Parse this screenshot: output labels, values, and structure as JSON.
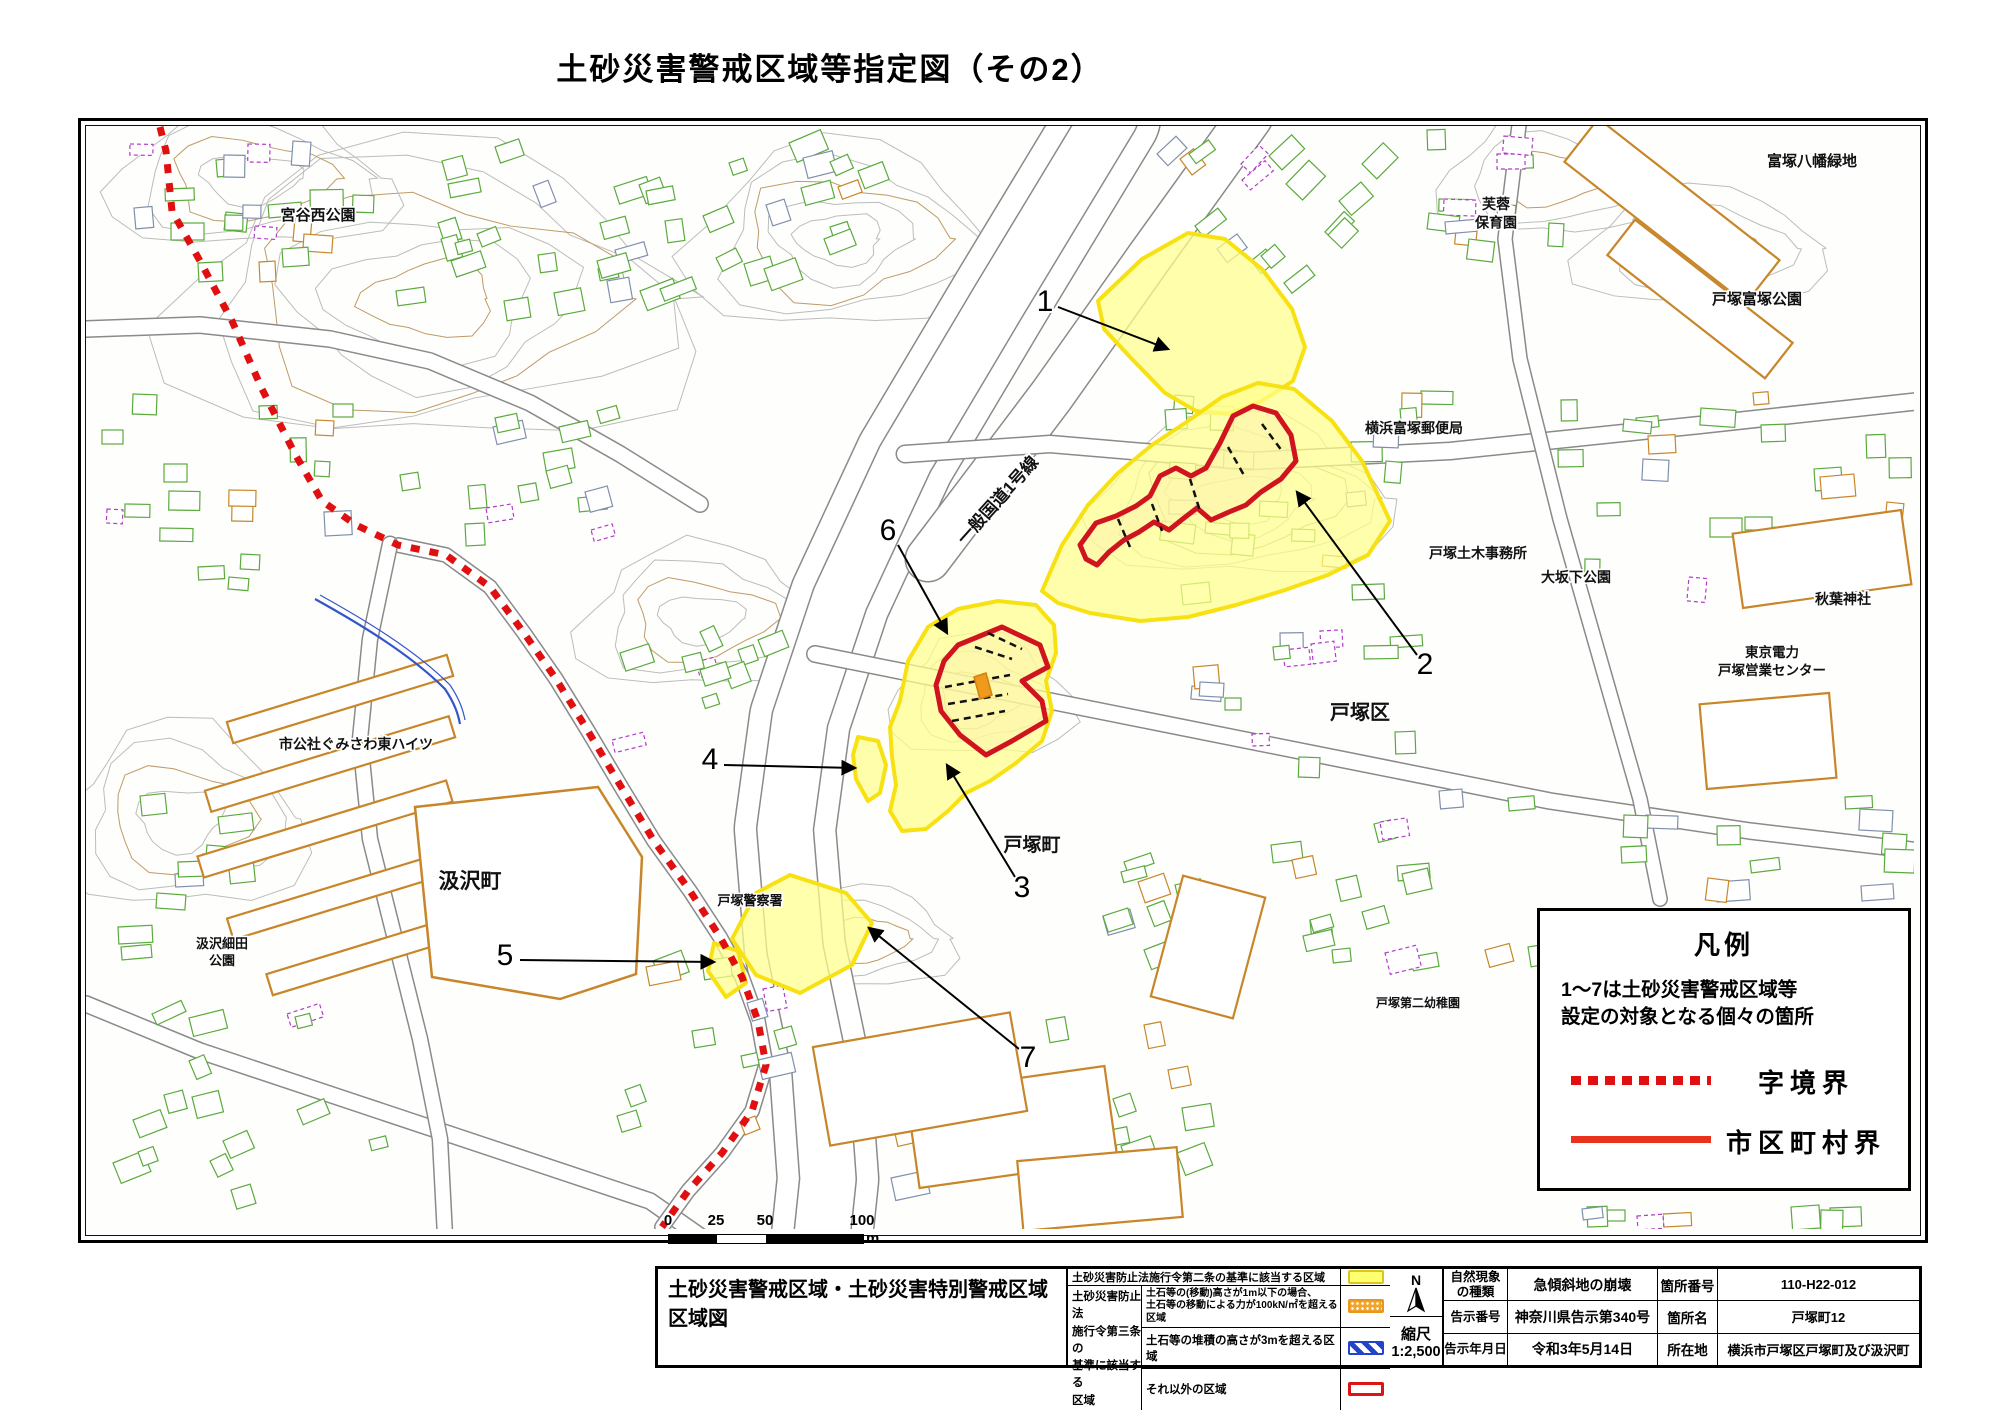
{
  "title": "土砂災害警戒区域等指定図（その2）",
  "colors": {
    "warning_yellow_fill": "#ffff8c",
    "warning_yellow_border": "#f7e112",
    "special_red": "#cf1420",
    "orange_zone": "#ef9a1c",
    "boundary_dotted_red": "#e01010",
    "municipal_solid_red": "#e8321e",
    "blue_zone": "#2244cc"
  },
  "legend_box": {
    "title": "凡例",
    "note_line1": "1～7は土砂災害警戒区域等",
    "note_line2": "設定の対象となる個々の箇所",
    "items": [
      {
        "style": "dotted",
        "label": "字境界"
      },
      {
        "style": "solid",
        "label": "市区町村界"
      }
    ]
  },
  "scale_bar": {
    "t0": "0",
    "t25": "25",
    "t50": "50",
    "t100": "100",
    "unit": "m"
  },
  "info_table": {
    "block_title_1": "土砂災害警戒区域・土砂災害特別警戒区域",
    "block_title_2": "区域図",
    "law2_text": "土砂災害防止法施行令第二条の基準に該当する区域",
    "law3_l1": "土砂災害防止法",
    "law3_l2": "施行令第三条の",
    "law3_l3": "基準に該当する",
    "law3_l4": "区域",
    "law3_row1a": "土石等の(移動)高さが1m以下の場合、",
    "law3_row1b": "土石等の移動による力が100kN/㎡を超える区域",
    "law3_row2": "土石等の堆積の高さが3mを超える区域",
    "law3_row3": "それ以外の区域",
    "compass_n": "N",
    "scale_label": "縮尺",
    "scale_value": "1:2,500",
    "nat_label_1": "自然現象",
    "nat_label_2": "の種類",
    "nat_value": "急傾斜地の崩壊",
    "site_no_label": "箇所番号",
    "site_no_value": "110-H22-012",
    "notice_label": "告示番号",
    "notice_value": "神奈川県告示第340号",
    "site_name_label": "箇所名",
    "site_name_value": "戸塚町12",
    "date_label": "告示年月日",
    "date_value": "令和3年5月14日",
    "loc_label": "所在地",
    "loc_value": "横浜市戸塚区戸塚町及び汲沢町"
  },
  "map": {
    "road_label": {
      "text": "一般国道1号線",
      "x": 1002,
      "y": 505,
      "angle": -48,
      "size": 17
    },
    "labels": [
      {
        "t": [
          "宮谷西公園"
        ],
        "x": 318,
        "y": 221,
        "s": 15
      },
      {
        "t": [
          "富塚八幡緑地"
        ],
        "x": 1812,
        "y": 167,
        "s": 15
      },
      {
        "t": [
          "芙蓉",
          "保育園"
        ],
        "x": 1496,
        "y": 210,
        "s": 14
      },
      {
        "t": [
          "戸塚富塚公園"
        ],
        "x": 1757,
        "y": 305,
        "s": 15
      },
      {
        "t": [
          "横浜富塚郵便局"
        ],
        "x": 1414,
        "y": 434,
        "s": 14
      },
      {
        "t": [
          "戸塚土木事務所"
        ],
        "x": 1478,
        "y": 559,
        "s": 14
      },
      {
        "t": [
          "大坂下公園"
        ],
        "x": 1576,
        "y": 583,
        "s": 14
      },
      {
        "t": [
          "秋葉神社"
        ],
        "x": 1843,
        "y": 605,
        "s": 14
      },
      {
        "t": [
          "東京電力",
          "戸塚営業センター"
        ],
        "x": 1772,
        "y": 658,
        "s": 13.5
      },
      {
        "t": [
          "戸塚区"
        ],
        "x": 1360,
        "y": 720,
        "s": 20
      },
      {
        "t": [
          "市公社ぐみさわ東ハイツ"
        ],
        "x": 356,
        "y": 750,
        "s": 14
      },
      {
        "t": [
          "汲沢町"
        ],
        "x": 470,
        "y": 889,
        "s": 21
      },
      {
        "t": [
          "汲沢細田",
          "公園"
        ],
        "x": 222,
        "y": 949,
        "s": 13
      },
      {
        "t": [
          "戸塚警察署"
        ],
        "x": 750,
        "y": 906,
        "s": 13
      },
      {
        "t": [
          "戸塚町"
        ],
        "x": 1032,
        "y": 852,
        "s": 19
      },
      {
        "t": [
          "戸塚第二幼稚園"
        ],
        "x": 1418,
        "y": 1008,
        "s": 12
      }
    ],
    "sites": [
      {
        "n": "1",
        "tx": 1045,
        "ty": 304,
        "x1": 1058,
        "y1": 308,
        "x2": 1168,
        "y2": 350
      },
      {
        "n": "2",
        "tx": 1425,
        "ty": 667,
        "x1": 1417,
        "y1": 656,
        "x2": 1297,
        "y2": 493
      },
      {
        "n": "3",
        "tx": 1022,
        "ty": 890,
        "x1": 1015,
        "y1": 878,
        "x2": 947,
        "y2": 766
      },
      {
        "n": "4",
        "tx": 710,
        "ty": 762,
        "x1": 724,
        "y1": 766,
        "x2": 855,
        "y2": 769
      },
      {
        "n": "5",
        "tx": 505,
        "ty": 958,
        "x1": 520,
        "y1": 961,
        "x2": 714,
        "y2": 963
      },
      {
        "n": "6",
        "tx": 888,
        "ty": 533,
        "x1": 898,
        "y1": 546,
        "x2": 947,
        "y2": 634
      },
      {
        "n": "7",
        "tx": 1028,
        "ty": 1060,
        "x1": 1019,
        "y1": 1050,
        "x2": 869,
        "y2": 929
      }
    ],
    "zones_yellow": [
      [
        [
          1098,
          302
        ],
        [
          1142,
          260
        ],
        [
          1188,
          234
        ],
        [
          1225,
          240
        ],
        [
          1262,
          270
        ],
        [
          1292,
          310
        ],
        [
          1305,
          348
        ],
        [
          1293,
          382
        ],
        [
          1262,
          402
        ],
        [
          1228,
          415
        ],
        [
          1196,
          412
        ],
        [
          1165,
          394
        ],
        [
          1130,
          358
        ],
        [
          1104,
          330
        ]
      ],
      [
        [
          1042,
          592
        ],
        [
          1062,
          546
        ],
        [
          1088,
          506
        ],
        [
          1118,
          474
        ],
        [
          1152,
          446
        ],
        [
          1188,
          422
        ],
        [
          1222,
          398
        ],
        [
          1258,
          384
        ],
        [
          1294,
          390
        ],
        [
          1332,
          422
        ],
        [
          1362,
          462
        ],
        [
          1390,
          522
        ],
        [
          1368,
          556
        ],
        [
          1328,
          576
        ],
        [
          1282,
          592
        ],
        [
          1236,
          606
        ],
        [
          1188,
          618
        ],
        [
          1140,
          622
        ],
        [
          1090,
          614
        ],
        [
          1058,
          604
        ]
      ],
      [
        [
          900,
          702
        ],
        [
          908,
          662
        ],
        [
          928,
          628
        ],
        [
          958,
          610
        ],
        [
          998,
          602
        ],
        [
          1036,
          606
        ],
        [
          1054,
          626
        ],
        [
          1056,
          654
        ],
        [
          1046,
          682
        ],
        [
          1052,
          712
        ],
        [
          1042,
          742
        ],
        [
          1016,
          764
        ],
        [
          990,
          782
        ],
        [
          966,
          794
        ],
        [
          948,
          812
        ],
        [
          926,
          830
        ],
        [
          902,
          832
        ],
        [
          890,
          812
        ],
        [
          896,
          786
        ],
        [
          892,
          758
        ],
        [
          890,
          728
        ]
      ],
      [
        [
          858,
          738
        ],
        [
          878,
          742
        ],
        [
          886,
          766
        ],
        [
          880,
          794
        ],
        [
          868,
          802
        ],
        [
          856,
          780
        ],
        [
          853,
          756
        ]
      ],
      [
        [
          790,
          876
        ],
        [
          846,
          894
        ],
        [
          872,
          924
        ],
        [
          852,
          966
        ],
        [
          800,
          994
        ],
        [
          756,
          976
        ],
        [
          732,
          940
        ],
        [
          756,
          894
        ]
      ],
      [
        [
          714,
          944
        ],
        [
          738,
          952
        ],
        [
          746,
          984
        ],
        [
          726,
          998
        ],
        [
          708,
          972
        ]
      ]
    ],
    "zones_red": [
      [
        [
          1080,
          546
        ],
        [
          1096,
          524
        ],
        [
          1116,
          517
        ],
        [
          1136,
          507
        ],
        [
          1150,
          497
        ],
        [
          1160,
          477
        ],
        [
          1176,
          469
        ],
        [
          1191,
          477
        ],
        [
          1206,
          469
        ],
        [
          1220,
          444
        ],
        [
          1233,
          417
        ],
        [
          1253,
          407
        ],
        [
          1276,
          414
        ],
        [
          1291,
          436
        ],
        [
          1296,
          462
        ],
        [
          1281,
          480
        ],
        [
          1261,
          493
        ],
        [
          1246,
          506
        ],
        [
          1229,
          513
        ],
        [
          1211,
          521
        ],
        [
          1197,
          509
        ],
        [
          1184,
          519
        ],
        [
          1169,
          531
        ],
        [
          1154,
          523
        ],
        [
          1139,
          533
        ],
        [
          1124,
          541
        ],
        [
          1109,
          553
        ],
        [
          1097,
          566
        ],
        [
          1086,
          560
        ]
      ],
      [
        [
          958,
          646
        ],
        [
          1002,
          628
        ],
        [
          1040,
          646
        ],
        [
          1048,
          668
        ],
        [
          1022,
          682
        ],
        [
          1042,
          702
        ],
        [
          1046,
          722
        ],
        [
          1012,
          742
        ],
        [
          986,
          756
        ],
        [
          960,
          736
        ],
        [
          941,
          712
        ],
        [
          936,
          686
        ],
        [
          944,
          662
        ]
      ]
    ],
    "orange_bars": [
      [
        [
          974,
          678
        ],
        [
          986,
          674
        ],
        [
          992,
          696
        ],
        [
          980,
          700
        ]
      ]
    ],
    "special_ticks": [
      [
        1118,
        520,
        1130,
        548
      ],
      [
        1152,
        505,
        1162,
        532
      ],
      [
        1190,
        480,
        1200,
        512
      ],
      [
        1228,
        448,
        1245,
        478
      ],
      [
        1262,
        425,
        1282,
        452
      ],
      [
        945,
        688,
        1010,
        676
      ],
      [
        948,
        705,
        1008,
        695
      ],
      [
        952,
        722,
        1005,
        712
      ],
      [
        975,
        648,
        1012,
        660
      ],
      [
        988,
        634,
        1022,
        650
      ]
    ],
    "boundary_dotted": [
      [
        160,
        128
      ],
      [
        166,
        152
      ],
      [
        172,
        212
      ],
      [
        200,
        262
      ],
      [
        232,
        322
      ],
      [
        262,
        390
      ],
      [
        295,
        455
      ],
      [
        322,
        502
      ],
      [
        356,
        526
      ],
      [
        398,
        546
      ],
      [
        446,
        556
      ],
      [
        490,
        588
      ],
      [
        524,
        634
      ],
      [
        556,
        680
      ],
      [
        588,
        732
      ],
      [
        620,
        786
      ],
      [
        654,
        842
      ],
      [
        690,
        892
      ],
      [
        720,
        938
      ],
      [
        742,
        978
      ],
      [
        758,
        1022
      ],
      [
        766,
        1066
      ],
      [
        752,
        1112
      ],
      [
        722,
        1154
      ],
      [
        688,
        1192
      ],
      [
        662,
        1228
      ]
    ]
  }
}
